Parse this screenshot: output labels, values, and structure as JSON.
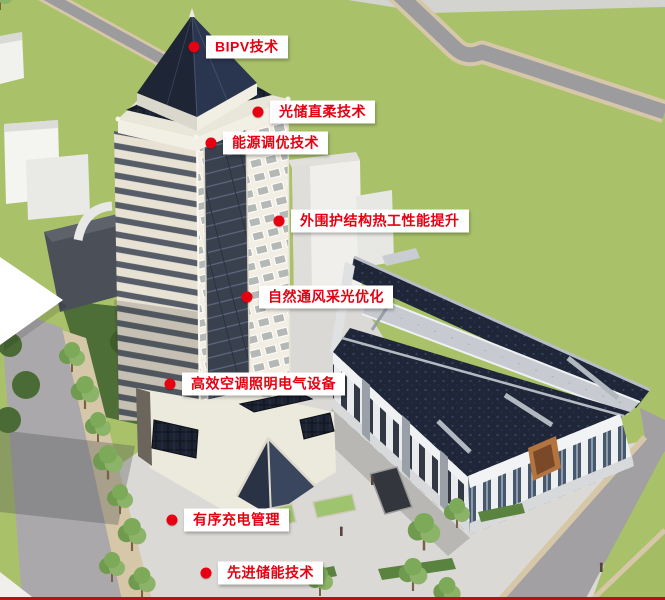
{
  "annotations": [
    {
      "id": "bipv",
      "label": "BIPV技术"
    },
    {
      "id": "pv-storage-dc-flex",
      "label": "光储直柔技术"
    },
    {
      "id": "energy-tuning",
      "label": "能源调优技术"
    },
    {
      "id": "envelope-thermal",
      "label": "外围护结构热工性能提升"
    },
    {
      "id": "natural-vent-daylight",
      "label": "自然通风采光优化"
    },
    {
      "id": "hvac-lighting-electrical",
      "label": "高效空调照明电气设备"
    },
    {
      "id": "orderly-ev-charging",
      "label": "有序充电管理"
    },
    {
      "id": "advanced-energy-storage",
      "label": "先进储能技术"
    }
  ],
  "colors": {
    "accent_red": "#e60012",
    "label_bg": "#ffffff",
    "divider_red": "#b3121a",
    "lawn_green": "#a9c169",
    "shaded_lawn_green": "#4e6e37",
    "roof_navy": "#1f2638",
    "facade_cream": "#efe9db",
    "road_gray": "#9c9c9e",
    "plaza_gray": "#dbd9d5",
    "sidewalk_tan": "#d6c7a9"
  }
}
